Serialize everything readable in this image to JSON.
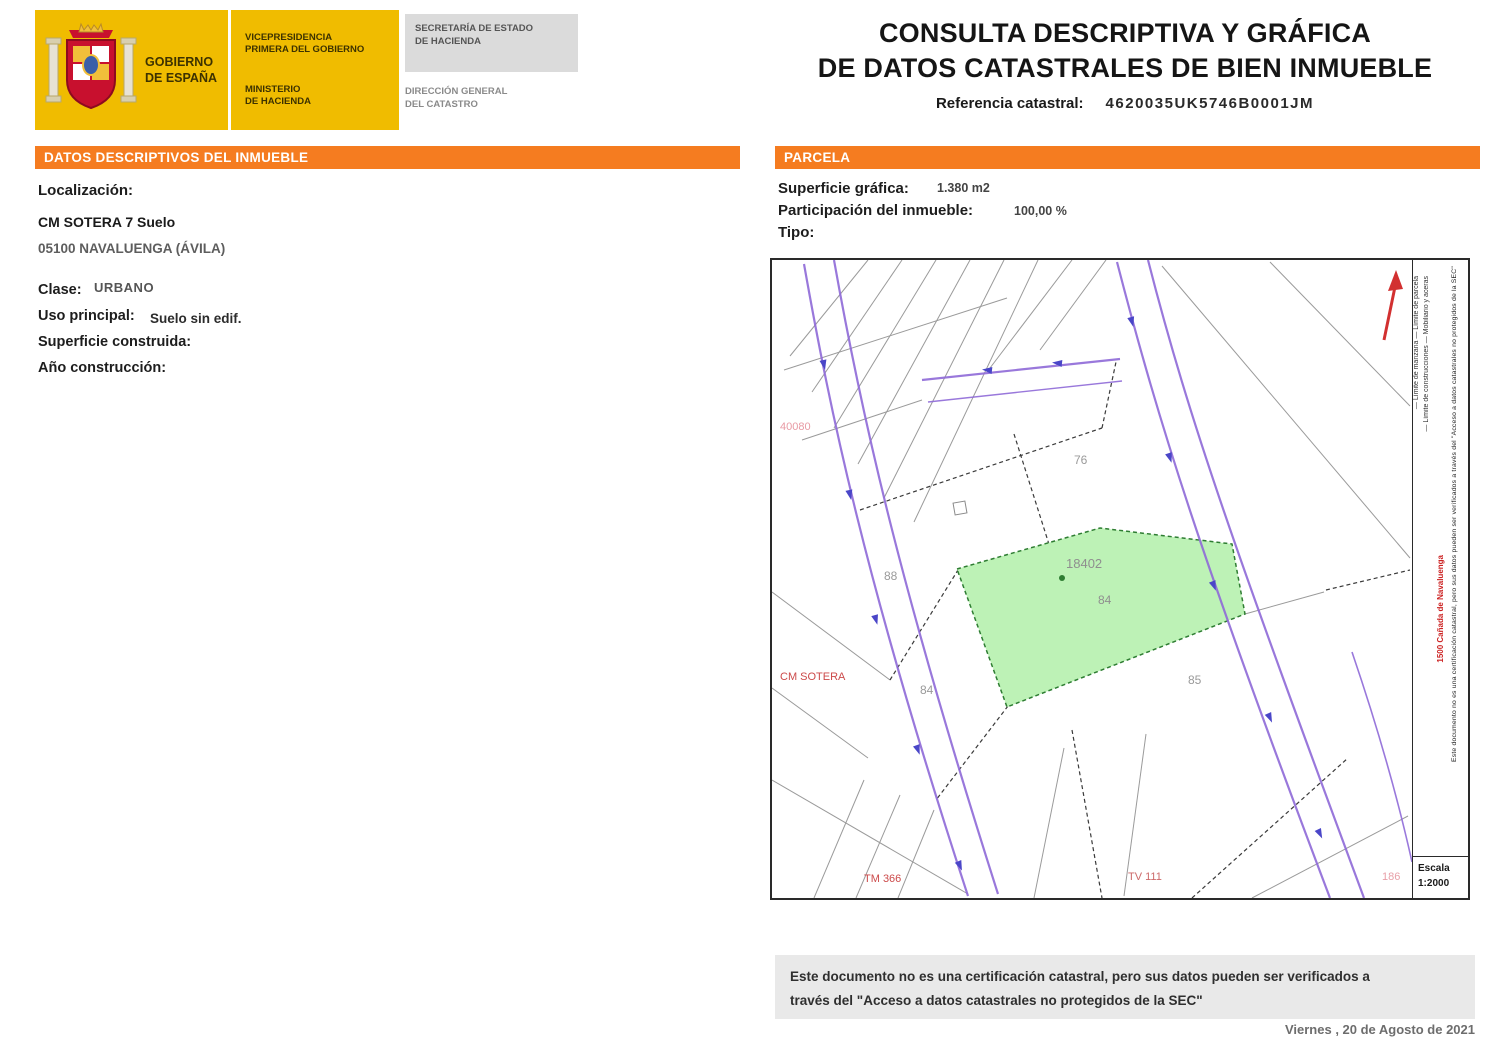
{
  "header": {
    "government_line1": "GOBIERNO",
    "government_line2": "DE ESPAÑA",
    "vp_line1": "VICEPRESIDENCIA",
    "vp_line2": "PRIMERA DEL GOBIERNO",
    "min_line1": "MINISTERIO",
    "min_line2": "DE HACIENDA",
    "sec_line1": "SECRETARÍA DE ESTADO",
    "sec_line2": "DE HACIENDA",
    "dir_line1": "DIRECCIÓN GENERAL",
    "dir_line2": "DEL CATASTRO",
    "title_line1": "CONSULTA DESCRIPTIVA Y GRÁFICA",
    "title_line2": "DE DATOS CATASTRALES DE BIEN INMUEBLE",
    "ref_label": "Referencia catastral:",
    "ref_value": "4620035UK5746B0001JM"
  },
  "datos": {
    "section_title": "DATOS DESCRIPTIVOS DEL INMUEBLE",
    "localizacion_label": "Localización:",
    "address_line1": "CM SOTERA 7 Suelo",
    "address_line2": "05100 NAVALUENGA (ÁVILA)",
    "clase_label": "Clase:",
    "clase_value": "URBANO",
    "uso_label": "Uso principal:",
    "uso_value": "Suelo sin edif.",
    "superficie_label": "Superficie construida:",
    "anio_label": "Año construcción:"
  },
  "parcela": {
    "section_title": "PARCELA",
    "superficie_label": "Superficie gráfica:",
    "superficie_value": "1.380 m2",
    "participacion_label": "Participación del inmueble:",
    "participacion_value": "100,00 %",
    "tipo_label": "Tipo:"
  },
  "map": {
    "parcel_number": "18402",
    "parcel_subnumber": "84",
    "numbers": {
      "n76": "76",
      "n88": "88",
      "n84": "84",
      "n85": "85"
    },
    "street_labels": {
      "top_left": "40080",
      "mid_left": "CM SOTERA",
      "bottom_left": "TM 366",
      "bottom_center": "TV 111",
      "bottom_right": "186"
    },
    "margin": {
      "legend_line1": "— Límite de manzana    — Límite de parcela",
      "legend_line2": "— Límite de construcciones    — Mobiliario y aceras",
      "red_line": "1500 Cañada de Navaluenga",
      "outer_line": "Este documento no es una certificación catastral, pero sus datos pueden ser verificados a través del \"Acceso a datos catastrales no protegidos de la SEC\""
    },
    "scale_label": "Escala",
    "scale_value": "1:2000"
  },
  "footer": {
    "disclaimer_line1": "Este documento no es una certificación catastral, pero sus datos pueden ser verificados a",
    "disclaimer_line2": "través del \"Acceso a datos catastrales no protegidos de la SEC\"",
    "date": "Viernes , 20 de Agosto de 2021"
  },
  "colors": {
    "orange": "#F57C20",
    "yellow": "#F0BC00",
    "green_fill": "#BDF2B6",
    "purple_road": "#8F6AD8"
  }
}
